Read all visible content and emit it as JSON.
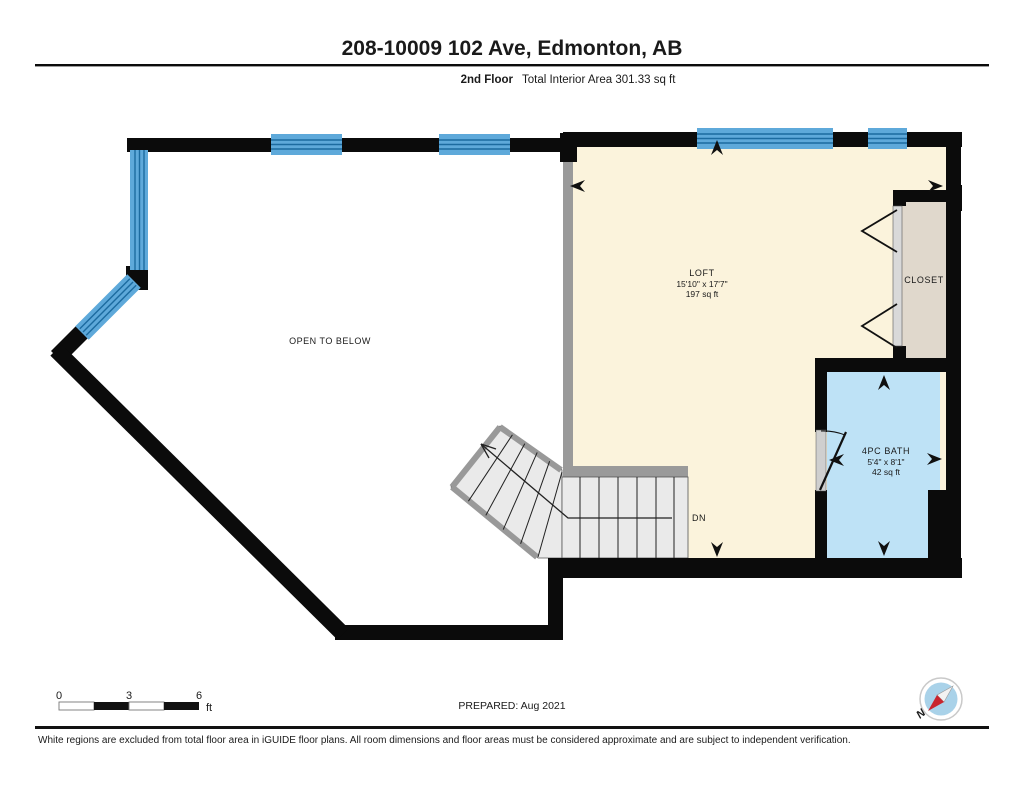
{
  "header": {
    "title": "208-10009 102 Ave, Edmonton, AB",
    "floor_label": "2nd Floor",
    "area_label": "Total Interior Area 301.33 sq ft"
  },
  "plan": {
    "open_below_label": "OPEN TO BELOW",
    "rooms": [
      {
        "name": "LOFT",
        "dims": "15'10\" x 17'7\"",
        "area": "197 sq ft"
      },
      {
        "name": "4PC BATH",
        "dims": "5'4\" x 8'1\"",
        "area": "42 sq ft"
      },
      {
        "name": "CLOSET"
      }
    ],
    "stairs_label": "DN"
  },
  "footer": {
    "scale": {
      "t0": "0",
      "t1": "3",
      "t2": "6",
      "unit": "ft"
    },
    "prepared": "PREPARED: Aug 2021",
    "compass_n": "N",
    "disclaimer": "White regions are excluded from total floor area in iGUIDE floor plans. All room dimensions and floor areas must be considered approximate and are subject to independent verification."
  },
  "colors": {
    "wall": "#0b0b0b",
    "window_fill": "#5EA9DA",
    "window_line": "#1C6BA0",
    "loft_fill": "#FBF3DC",
    "bath_fill": "#BEE2F6",
    "closet_fill": "#E0D8CC",
    "stairs_fill": "#EAEAEA",
    "divider_gray": "#9A9A9A",
    "compass_blue": "#A9D2E9",
    "compass_red": "#C9252D"
  }
}
